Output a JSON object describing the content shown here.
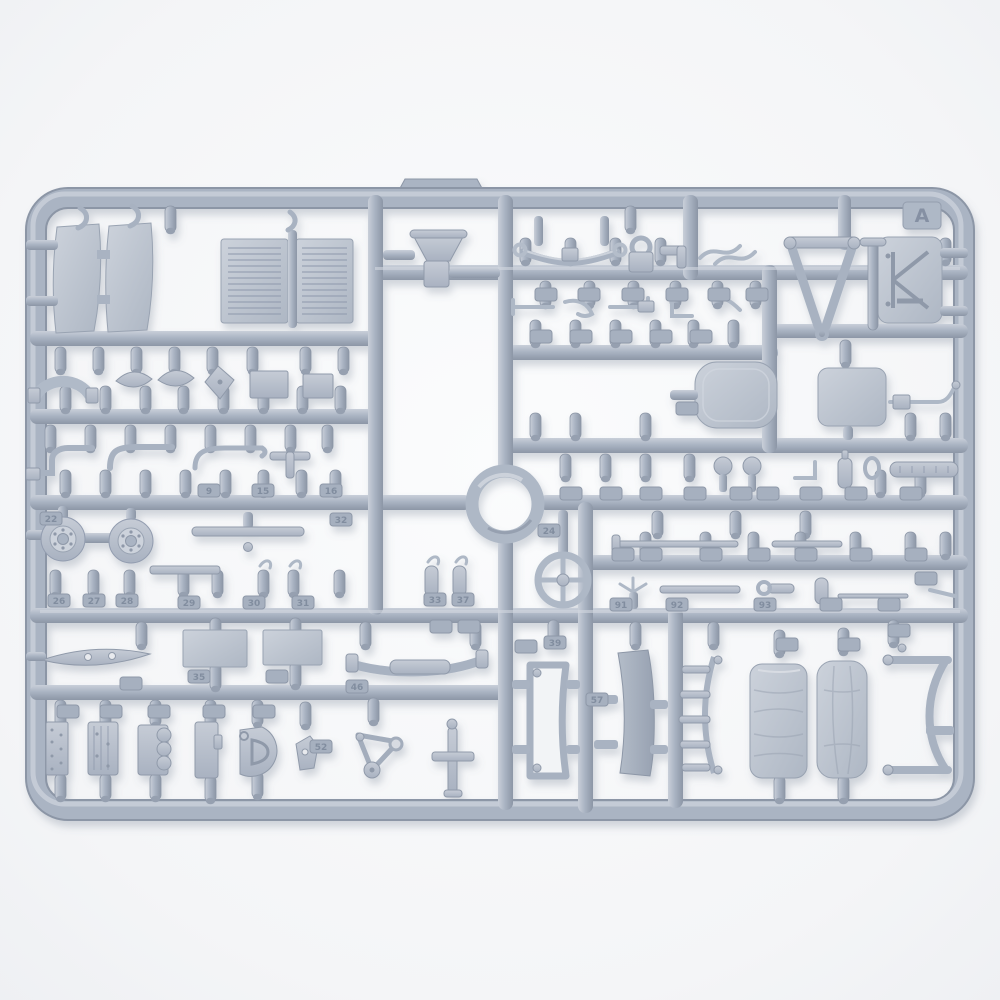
{
  "scene": {
    "type": "product-photograph",
    "subject": "injection-molded plastic model kit sprue (parts tree) of light blue-gray styrene on a white studio background",
    "sprue_letter": "A",
    "description": "Landscape rounded-rectangle sprue frame with an internal grid of runners holding ~90 small vehicle parts: hood side panels, two louvered radiator grilles, seat funnel, leaf spring, V-shaped tow bar, braced K-panel, door panels, two road wheels, a large ring, a spoked steering wheel, engine blocks, rolled tarpaulins, curved frame members, rods, mirrors and many numbered attachment tabs",
    "molding_gate_bump": "raised trapezoid on the top frame edge left of center"
  },
  "colors": {
    "background_center": "#fbfcfd",
    "background_edge": "#edeff2",
    "plastic_mid": "#aab4c3",
    "plastic_light": "#c9cfd9",
    "plastic_dark": "#8c96a6",
    "part_fill_light": "#c6ccd6",
    "part_fill_dark": "#a9b2c1",
    "tab_fill": "#a6b0bf",
    "embossed_text": "#7e8a9c",
    "photo_shadow": "#6b7688"
  },
  "part_number_tabs": [
    {
      "x": 40,
      "y": 512,
      "label": "22"
    },
    {
      "x": 198,
      "y": 484,
      "label": "9"
    },
    {
      "x": 252,
      "y": 484,
      "label": "15"
    },
    {
      "x": 320,
      "y": 484,
      "label": "16"
    },
    {
      "x": 330,
      "y": 513,
      "label": "32"
    },
    {
      "x": 48,
      "y": 594,
      "label": "26"
    },
    {
      "x": 83,
      "y": 594,
      "label": "27"
    },
    {
      "x": 116,
      "y": 594,
      "label": "28"
    },
    {
      "x": 178,
      "y": 596,
      "label": "29"
    },
    {
      "x": 243,
      "y": 596,
      "label": "30"
    },
    {
      "x": 292,
      "y": 596,
      "label": "31"
    },
    {
      "x": 424,
      "y": 593,
      "label": "33"
    },
    {
      "x": 452,
      "y": 593,
      "label": "37"
    },
    {
      "x": 538,
      "y": 524,
      "label": "24"
    },
    {
      "x": 544,
      "y": 636,
      "label": "39"
    },
    {
      "x": 346,
      "y": 680,
      "label": "46"
    },
    {
      "x": 188,
      "y": 670,
      "label": "35"
    },
    {
      "x": 586,
      "y": 693,
      "label": "57"
    },
    {
      "x": 310,
      "y": 740,
      "label": "52"
    },
    {
      "x": 610,
      "y": 598,
      "label": "91"
    },
    {
      "x": 666,
      "y": 598,
      "label": "92"
    },
    {
      "x": 754,
      "y": 598,
      "label": "93"
    },
    {
      "x": 535,
      "y": 288,
      "label": ""
    },
    {
      "x": 578,
      "y": 288,
      "label": ""
    },
    {
      "x": 622,
      "y": 288,
      "label": ""
    },
    {
      "x": 666,
      "y": 288,
      "label": ""
    },
    {
      "x": 708,
      "y": 288,
      "label": ""
    },
    {
      "x": 746,
      "y": 288,
      "label": ""
    },
    {
      "x": 530,
      "y": 330,
      "label": ""
    },
    {
      "x": 570,
      "y": 330,
      "label": ""
    },
    {
      "x": 610,
      "y": 330,
      "label": ""
    },
    {
      "x": 650,
      "y": 330,
      "label": ""
    },
    {
      "x": 690,
      "y": 330,
      "label": ""
    },
    {
      "x": 560,
      "y": 487,
      "label": ""
    },
    {
      "x": 600,
      "y": 487,
      "label": ""
    },
    {
      "x": 640,
      "y": 487,
      "label": ""
    },
    {
      "x": 684,
      "y": 487,
      "label": ""
    },
    {
      "x": 730,
      "y": 487,
      "label": ""
    },
    {
      "x": 757,
      "y": 487,
      "label": ""
    },
    {
      "x": 800,
      "y": 487,
      "label": ""
    },
    {
      "x": 845,
      "y": 487,
      "label": ""
    },
    {
      "x": 900,
      "y": 487,
      "label": ""
    },
    {
      "x": 612,
      "y": 548,
      "label": ""
    },
    {
      "x": 640,
      "y": 548,
      "label": ""
    },
    {
      "x": 700,
      "y": 548,
      "label": ""
    },
    {
      "x": 748,
      "y": 548,
      "label": ""
    },
    {
      "x": 795,
      "y": 548,
      "label": ""
    },
    {
      "x": 850,
      "y": 548,
      "label": ""
    },
    {
      "x": 905,
      "y": 548,
      "label": ""
    },
    {
      "x": 820,
      "y": 598,
      "label": ""
    },
    {
      "x": 878,
      "y": 598,
      "label": ""
    },
    {
      "x": 57,
      "y": 705,
      "label": ""
    },
    {
      "x": 100,
      "y": 705,
      "label": ""
    },
    {
      "x": 148,
      "y": 705,
      "label": ""
    },
    {
      "x": 203,
      "y": 705,
      "label": ""
    },
    {
      "x": 253,
      "y": 705,
      "label": ""
    },
    {
      "x": 120,
      "y": 677,
      "label": ""
    },
    {
      "x": 266,
      "y": 670,
      "label": ""
    },
    {
      "x": 430,
      "y": 620,
      "label": ""
    },
    {
      "x": 458,
      "y": 620,
      "label": ""
    },
    {
      "x": 515,
      "y": 640,
      "label": ""
    },
    {
      "x": 776,
      "y": 638,
      "label": ""
    },
    {
      "x": 838,
      "y": 638,
      "label": ""
    },
    {
      "x": 888,
      "y": 624,
      "label": ""
    },
    {
      "x": 676,
      "y": 402,
      "label": ""
    },
    {
      "x": 915,
      "y": 572,
      "label": ""
    }
  ]
}
